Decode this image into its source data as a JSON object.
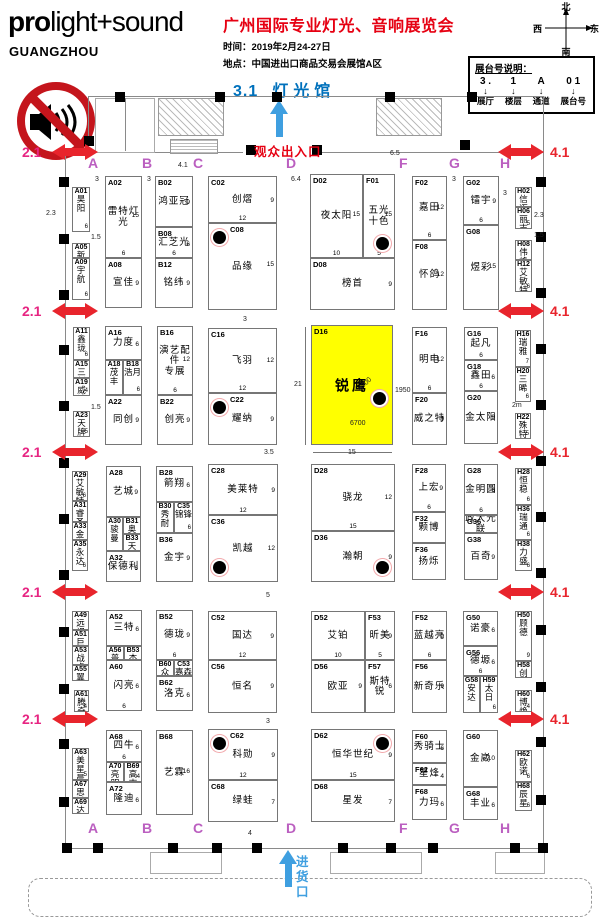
{
  "logo": {
    "pro": "pro",
    "rest": "light+sound",
    "city": "GUANGZHOU"
  },
  "header": {
    "title": "广州国际专业灯光、音响展览会",
    "date_line": "时间：2019年2月24-27日",
    "venue_line": "地点：中国进出口商品交易会展馆A区",
    "hall_no": "3.1",
    "hall_name": "灯光馆"
  },
  "compass": {
    "n": "北",
    "s": "南",
    "e": "东",
    "w": "西"
  },
  "legend": {
    "title": "展台号说明：",
    "arrow_icon": "↓",
    "cols": [
      {
        "part": "3 .",
        "meaning": "展厅"
      },
      {
        "part": "1",
        "meaning": "楼层"
      },
      {
        "part": "A",
        "meaning": "通道"
      },
      {
        "part": "0 1",
        "meaning": "展台号"
      }
    ]
  },
  "entrances": {
    "visitor": "观众出入口",
    "goods": "进货口"
  },
  "aisle_letters": {
    "top_y": 155,
    "bottom_y": 820,
    "items": [
      {
        "t": "A",
        "x": 88
      },
      {
        "t": "B",
        "x": 142
      },
      {
        "t": "C",
        "x": 193
      },
      {
        "t": "D",
        "x": 286
      },
      {
        "t": "F",
        "x": 399
      },
      {
        "t": "G",
        "x": 449
      },
      {
        "t": "H",
        "x": 500
      }
    ]
  },
  "side_arrows": {
    "left_label": "2.1",
    "right_label": "4.1",
    "rows": [
      144,
      303,
      444,
      584,
      711
    ]
  },
  "highlight": {
    "booth": "D16",
    "color": "#ffff00"
  },
  "booths": [
    {
      "id": "A01",
      "nm": "昊阳",
      "x": 72,
      "y": 187,
      "w": 18,
      "h": 45,
      "n": "6"
    },
    {
      "id": "A05",
      "nm": "新产业",
      "x": 72,
      "y": 243,
      "w": 18,
      "h": 15
    },
    {
      "id": "A09",
      "nm": "宇航",
      "x": 72,
      "y": 258,
      "w": 18,
      "h": 42,
      "n": "6"
    },
    {
      "id": "A02",
      "nm": "雷特灯光",
      "x": 105,
      "y": 176,
      "w": 37,
      "h": 82,
      "n": "15",
      "wn": "6"
    },
    {
      "id": "A08",
      "nm": "宣佳",
      "x": 105,
      "y": 258,
      "w": 37,
      "h": 50,
      "n": "9"
    },
    {
      "id": "B02",
      "nm": "鸿亚冠",
      "x": 155,
      "y": 176,
      "w": 38,
      "h": 51,
      "n": "9"
    },
    {
      "id": "B08",
      "nm": "汇芝光",
      "x": 155,
      "y": 227,
      "w": 38,
      "h": 31,
      "n": "6",
      "wn": "6"
    },
    {
      "id": "B12",
      "nm": "铭纬",
      "x": 155,
      "y": 258,
      "w": 38,
      "h": 50,
      "n": "9"
    },
    {
      "id": "C02",
      "nm": "创熠",
      "x": 208,
      "y": 176,
      "w": 69,
      "h": 47,
      "n": "9",
      "wn": "12"
    },
    {
      "id": "C08",
      "nm": "品缘",
      "x": 208,
      "y": 223,
      "w": 69,
      "h": 87,
      "n": "15",
      "p": "tl"
    },
    {
      "id": "D02",
      "nm": "夜太阳",
      "x": 310,
      "y": 174,
      "w": 53,
      "h": 84,
      "n": "15",
      "wn": "10"
    },
    {
      "id": "F01",
      "nm": "五光\n十色",
      "x": 363,
      "y": 174,
      "w": 32,
      "h": 84,
      "n": "15",
      "wn": "5",
      "p": "br"
    },
    {
      "id": "D08",
      "nm": "榜首",
      "x": 310,
      "y": 258,
      "w": 85,
      "h": 52,
      "n": "9"
    },
    {
      "id": "F02",
      "nm": "嘉田",
      "x": 412,
      "y": 176,
      "w": 35,
      "h": 64,
      "n": "12",
      "wn": "6"
    },
    {
      "id": "F08",
      "nm": "怀鸽",
      "x": 412,
      "y": 240,
      "w": 35,
      "h": 70,
      "n": "12"
    },
    {
      "id": "G02",
      "nm": "镭宇",
      "x": 463,
      "y": 176,
      "w": 36,
      "h": 49,
      "n": "9",
      "wn": "6"
    },
    {
      "id": "G08",
      "nm": "煜彩",
      "x": 463,
      "y": 225,
      "w": 36,
      "h": 85,
      "n": "15"
    },
    {
      "id": "H02",
      "nm": "信迈",
      "x": 515,
      "y": 187,
      "w": 17,
      "h": 20
    },
    {
      "id": "H06",
      "nm": "丽志",
      "x": 515,
      "y": 207,
      "w": 17,
      "h": 22,
      "n": "5"
    },
    {
      "id": "H08",
      "nm": "伟峰",
      "x": 515,
      "y": 240,
      "w": 17,
      "h": 20
    },
    {
      "id": "H12",
      "nm": "艾敏特",
      "x": 515,
      "y": 260,
      "w": 17,
      "h": 32,
      "n": "6"
    },
    {
      "id": "A11",
      "nm": "鑫珑",
      "x": 73,
      "y": 327,
      "w": 17,
      "h": 33,
      "n": "6"
    },
    {
      "id": "A15",
      "nm": "三新",
      "x": 73,
      "y": 360,
      "w": 17,
      "h": 18
    },
    {
      "id": "A19",
      "nm": "威浦",
      "x": 73,
      "y": 378,
      "w": 17,
      "h": 18,
      "n": "4"
    },
    {
      "id": "A23",
      "nm": "天牌",
      "x": 73,
      "y": 411,
      "w": 17,
      "h": 26,
      "n": "5"
    },
    {
      "id": "A16",
      "nm": "力度",
      "x": 105,
      "y": 326,
      "w": 37,
      "h": 34,
      "n": "6"
    },
    {
      "id": "A18",
      "nm": "茂丰",
      "x": 105,
      "y": 360,
      "w": 18,
      "h": 35
    },
    {
      "id": "B18",
      "nm": "浩月",
      "x": 123,
      "y": 360,
      "w": 19,
      "h": 35,
      "n": "6"
    },
    {
      "id": "A22",
      "nm": "同创",
      "x": 105,
      "y": 395,
      "w": 37,
      "h": 50,
      "n": "9"
    },
    {
      "id": "B16",
      "nm": "演艺配件\n专展",
      "x": 157,
      "y": 326,
      "w": 36,
      "h": 69,
      "n": "12",
      "wn": "6"
    },
    {
      "id": "B22",
      "nm": "创亮",
      "x": 157,
      "y": 395,
      "w": 36,
      "h": 50,
      "n": "9"
    },
    {
      "id": "C16",
      "nm": "飞羽",
      "x": 208,
      "y": 328,
      "w": 69,
      "h": 65,
      "n": "12",
      "wn": "12"
    },
    {
      "id": "C22",
      "nm": "耀纳",
      "x": 208,
      "y": 393,
      "w": 69,
      "h": 52,
      "n": "9",
      "p": "tl"
    },
    {
      "id": "D16",
      "nm": "锐鹰",
      "x": 311,
      "y": 325,
      "w": 82,
      "h": 120,
      "hl": true,
      "p": "rm"
    },
    {
      "id": "F16",
      "nm": "明电",
      "x": 412,
      "y": 327,
      "w": 35,
      "h": 66,
      "n": "12",
      "wn": "6"
    },
    {
      "id": "F20",
      "nm": "威之特",
      "x": 412,
      "y": 393,
      "w": 35,
      "h": 52,
      "n": "9"
    },
    {
      "id": "G16",
      "nm": "起凡",
      "x": 464,
      "y": 327,
      "w": 34,
      "h": 33,
      "wn": "6"
    },
    {
      "id": "G18",
      "nm": "鑫田",
      "x": 464,
      "y": 360,
      "w": 34,
      "h": 31,
      "n": "6",
      "wn": "6"
    },
    {
      "id": "G20",
      "nm": "金太阳",
      "x": 464,
      "y": 391,
      "w": 34,
      "h": 53,
      "n": "9"
    },
    {
      "id": "H16",
      "nm": "瑞雅",
      "x": 515,
      "y": 330,
      "w": 16,
      "h": 37,
      "n": "7"
    },
    {
      "id": "H20",
      "nm": "三晞",
      "x": 515,
      "y": 367,
      "w": 16,
      "h": 35,
      "n": "6"
    },
    {
      "id": "H22",
      "nm": "殊特",
      "x": 515,
      "y": 413,
      "w": 16,
      "h": 26,
      "n": "5"
    },
    {
      "id": "A29",
      "nm": "艾敏特",
      "x": 72,
      "y": 471,
      "w": 16,
      "h": 30,
      "n": "6"
    },
    {
      "id": "A31",
      "nm": "睿圣",
      "x": 72,
      "y": 501,
      "w": 16,
      "h": 21
    },
    {
      "id": "A33",
      "nm": "金海洋",
      "x": 72,
      "y": 522,
      "w": 16,
      "h": 18
    },
    {
      "id": "A35",
      "nm": "永达",
      "x": 72,
      "y": 540,
      "w": 16,
      "h": 31,
      "n": "6"
    },
    {
      "id": "A28",
      "nm": "艺城",
      "x": 106,
      "y": 466,
      "w": 35,
      "h": 51,
      "n": "9"
    },
    {
      "id": "A30",
      "nm": "骏曼",
      "x": 106,
      "y": 517,
      "w": 17,
      "h": 34
    },
    {
      "id": "B31",
      "nm": "奥音德",
      "x": 123,
      "y": 517,
      "w": 18,
      "h": 17
    },
    {
      "id": "B33",
      "nm": "天骄",
      "x": 123,
      "y": 534,
      "w": 18,
      "h": 17
    },
    {
      "id": "A32",
      "nm": "保德利",
      "x": 106,
      "y": 551,
      "w": 35,
      "h": 31,
      "n": "6"
    },
    {
      "id": "B28",
      "nm": "箭翔",
      "x": 156,
      "y": 466,
      "w": 37,
      "h": 36,
      "n": "6"
    },
    {
      "id": "B30",
      "nm": "秀耐",
      "x": 156,
      "y": 502,
      "w": 18,
      "h": 31
    },
    {
      "id": "C35",
      "nm": "锦锋",
      "x": 174,
      "y": 502,
      "w": 19,
      "h": 31,
      "n": "6"
    },
    {
      "id": "B36",
      "nm": "金宇",
      "x": 156,
      "y": 533,
      "w": 37,
      "h": 49,
      "n": "9"
    },
    {
      "id": "C28",
      "nm": "美莱特",
      "x": 208,
      "y": 464,
      "w": 70,
      "h": 51,
      "n": "9",
      "wn": "12"
    },
    {
      "id": "C36",
      "nm": "凯越",
      "x": 208,
      "y": 515,
      "w": 70,
      "h": 67,
      "n": "12",
      "p": "bl"
    },
    {
      "id": "D28",
      "nm": "骁龙",
      "x": 311,
      "y": 464,
      "w": 84,
      "h": 67,
      "n": "12",
      "wn": "15"
    },
    {
      "id": "D36",
      "nm": "瀚朝",
      "x": 311,
      "y": 531,
      "w": 84,
      "h": 51,
      "n": "9",
      "p": "br"
    },
    {
      "id": "F28",
      "nm": "上宏",
      "x": 412,
      "y": 464,
      "w": 34,
      "h": 48,
      "n": "9",
      "wn": "6"
    },
    {
      "id": "F32",
      "nm": "颗博",
      "x": 412,
      "y": 512,
      "w": 34,
      "h": 31
    },
    {
      "id": "F36",
      "nm": "扬烁",
      "x": 412,
      "y": 543,
      "w": 34,
      "h": 37
    },
    {
      "id": "G28",
      "nm": "金明圆",
      "x": 464,
      "y": 464,
      "w": 34,
      "h": 51,
      "n": "6",
      "wn": "6"
    },
    {
      "id": "G36",
      "nm": "政大光联",
      "x": 464,
      "y": 515,
      "w": 34,
      "h": 18
    },
    {
      "id": "G38",
      "nm": "百奇",
      "x": 464,
      "y": 533,
      "w": 34,
      "h": 47,
      "n": "9"
    },
    {
      "id": "H28",
      "nm": "恒稳",
      "x": 515,
      "y": 468,
      "w": 17,
      "h": 37,
      "n": "6"
    },
    {
      "id": "H36",
      "nm": "瑞通",
      "x": 515,
      "y": 505,
      "w": 17,
      "h": 35,
      "n": "6"
    },
    {
      "id": "H38",
      "nm": "力盛",
      "x": 515,
      "y": 540,
      "w": 17,
      "h": 31,
      "n": "6"
    },
    {
      "id": "A49",
      "nm": "远视",
      "x": 72,
      "y": 611,
      "w": 17,
      "h": 19
    },
    {
      "id": "A51",
      "nm": "巨盈",
      "x": 72,
      "y": 630,
      "w": 17,
      "h": 16
    },
    {
      "id": "A53",
      "nm": "战虎",
      "x": 72,
      "y": 646,
      "w": 17,
      "h": 19
    },
    {
      "id": "A55",
      "nm": "翼德",
      "x": 72,
      "y": 665,
      "w": 17,
      "h": 16
    },
    {
      "id": "A61",
      "nm": "腾奇",
      "x": 74,
      "y": 690,
      "w": 15,
      "h": 22,
      "n": "4"
    },
    {
      "id": "A52",
      "nm": "三特",
      "x": 106,
      "y": 610,
      "w": 36,
      "h": 36,
      "n": "6"
    },
    {
      "id": "A56",
      "nm": "普慧",
      "x": 106,
      "y": 646,
      "w": 18,
      "h": 14
    },
    {
      "id": "B53",
      "nm": "杰江",
      "x": 124,
      "y": 646,
      "w": 18,
      "h": 14
    },
    {
      "id": "A60",
      "nm": "闪亮",
      "x": 106,
      "y": 660,
      "w": 36,
      "h": 51,
      "n": "6",
      "wn": "6"
    },
    {
      "id": "B52",
      "nm": "德珑",
      "x": 156,
      "y": 610,
      "w": 37,
      "h": 50,
      "n": "9",
      "wn": "6"
    },
    {
      "id": "B60",
      "nm": "众纳",
      "x": 156,
      "y": 660,
      "w": 18,
      "h": 16
    },
    {
      "id": "C53",
      "nm": "嘉森",
      "x": 174,
      "y": 660,
      "w": 19,
      "h": 16
    },
    {
      "id": "B62",
      "nm": "洛克",
      "x": 156,
      "y": 676,
      "w": 37,
      "h": 35,
      "n": "6"
    },
    {
      "id": "C52",
      "nm": "国达",
      "x": 208,
      "y": 611,
      "w": 69,
      "h": 49,
      "n": "9",
      "wn": "12"
    },
    {
      "id": "C56",
      "nm": "恒名",
      "x": 208,
      "y": 660,
      "w": 69,
      "h": 53,
      "n": "9"
    },
    {
      "id": "D52",
      "nm": "艾铂",
      "x": 311,
      "y": 611,
      "w": 54,
      "h": 49,
      "wn": "10"
    },
    {
      "id": "F53",
      "nm": "昕美",
      "x": 365,
      "y": 611,
      "w": 30,
      "h": 49,
      "n": "9",
      "wn": "5"
    },
    {
      "id": "D56",
      "nm": "欧亚",
      "x": 311,
      "y": 660,
      "w": 54,
      "h": 53,
      "n": "9"
    },
    {
      "id": "F57",
      "nm": "斯特锐",
      "x": 365,
      "y": 660,
      "w": 30,
      "h": 53,
      "n": "6"
    },
    {
      "id": "F52",
      "nm": "蓝越亮",
      "x": 412,
      "y": 611,
      "w": 35,
      "h": 49,
      "n": "9",
      "wn": "6"
    },
    {
      "id": "F56",
      "nm": "新奇乐",
      "x": 412,
      "y": 660,
      "w": 35,
      "h": 53,
      "n": "9"
    },
    {
      "id": "G50",
      "nm": "诺豪",
      "x": 463,
      "y": 611,
      "w": 35,
      "h": 35,
      "n": "6"
    },
    {
      "id": "G56",
      "nm": "德塬",
      "x": 463,
      "y": 646,
      "w": 35,
      "h": 30,
      "n": "6",
      "wn": "6"
    },
    {
      "id": "G58",
      "nm": "安达",
      "x": 463,
      "y": 676,
      "w": 17,
      "h": 37
    },
    {
      "id": "H59",
      "nm": "太日",
      "x": 480,
      "y": 676,
      "w": 18,
      "h": 37,
      "n": "6"
    },
    {
      "id": "H50",
      "nm": "顾德",
      "x": 515,
      "y": 611,
      "w": 17,
      "h": 50,
      "n": "9"
    },
    {
      "id": "H58",
      "nm": "创宇",
      "x": 515,
      "y": 661,
      "w": 17,
      "h": 17
    },
    {
      "id": "H60",
      "nm": "博焕",
      "x": 515,
      "y": 690,
      "w": 17,
      "h": 22,
      "n": "4"
    },
    {
      "id": "A63",
      "nm": "美星晨",
      "x": 72,
      "y": 748,
      "w": 17,
      "h": 32,
      "n": "5"
    },
    {
      "id": "A67",
      "nm": "思城",
      "x": 72,
      "y": 780,
      "w": 17,
      "h": 18
    },
    {
      "id": "A69",
      "nm": "达欣",
      "x": 72,
      "y": 798,
      "w": 17,
      "h": 16
    },
    {
      "id": "A68",
      "nm": "四牛",
      "x": 106,
      "y": 730,
      "w": 36,
      "h": 32,
      "n": "6",
      "wn": "6"
    },
    {
      "id": "A70",
      "nm": "亮明",
      "x": 106,
      "y": 762,
      "w": 18,
      "h": 20
    },
    {
      "id": "B69",
      "nm": "高志忠",
      "x": 124,
      "y": 762,
      "w": 18,
      "h": 20,
      "n": "4"
    },
    {
      "id": "A72",
      "nm": "隆迪",
      "x": 106,
      "y": 782,
      "w": 36,
      "h": 33,
      "n": "6"
    },
    {
      "id": "B68",
      "nm": "艺霖",
      "x": 156,
      "y": 730,
      "w": 37,
      "h": 85,
      "n": "16"
    },
    {
      "id": "C62",
      "nm": "科勋",
      "x": 208,
      "y": 729,
      "w": 70,
      "h": 51,
      "n": "9",
      "wn": "12",
      "p": "tl"
    },
    {
      "id": "C68",
      "nm": "绿蛙",
      "x": 208,
      "y": 780,
      "w": 70,
      "h": 42,
      "n": "7"
    },
    {
      "id": "D62",
      "nm": "恒华世纪",
      "x": 311,
      "y": 729,
      "w": 84,
      "h": 51,
      "n": "9",
      "wn": "15",
      "p": "tr"
    },
    {
      "id": "D68",
      "nm": "星发",
      "x": 311,
      "y": 780,
      "w": 84,
      "h": 42,
      "n": "7"
    },
    {
      "id": "F60",
      "nm": "秀骑士",
      "x": 412,
      "y": 730,
      "w": 35,
      "h": 33,
      "n": "6"
    },
    {
      "id": "F62",
      "nm": "星烽",
      "x": 412,
      "y": 763,
      "w": 35,
      "h": 22,
      "n": "4"
    },
    {
      "id": "F68",
      "nm": "力玛",
      "x": 412,
      "y": 785,
      "w": 35,
      "h": 35,
      "n": "6"
    },
    {
      "id": "G60",
      "nm": "金崴",
      "x": 463,
      "y": 730,
      "w": 35,
      "h": 57,
      "n": "10"
    },
    {
      "id": "G68",
      "nm": "丰业",
      "x": 463,
      "y": 787,
      "w": 35,
      "h": 33,
      "n": "6"
    },
    {
      "id": "H62",
      "nm": "欧诺",
      "x": 515,
      "y": 750,
      "w": 17,
      "h": 32,
      "n": "6"
    },
    {
      "id": "H68",
      "nm": "辰星",
      "x": 515,
      "y": 782,
      "w": 17,
      "h": 29,
      "n": "6"
    }
  ],
  "dims": [
    {
      "t": "3",
      "x": 95,
      "y": 176
    },
    {
      "t": "3",
      "x": 147,
      "y": 176
    },
    {
      "t": "4.1",
      "x": 178,
      "y": 162
    },
    {
      "t": "6.4",
      "x": 291,
      "y": 176
    },
    {
      "t": "6.5",
      "x": 390,
      "y": 150
    },
    {
      "t": "3",
      "x": 452,
      "y": 176
    },
    {
      "t": "3",
      "x": 503,
      "y": 190
    },
    {
      "t": "2.3",
      "x": 46,
      "y": 210
    },
    {
      "t": "1.5",
      "x": 91,
      "y": 234
    },
    {
      "t": "2.3",
      "x": 534,
      "y": 212
    },
    {
      "t": "1.5",
      "x": 534,
      "y": 232
    },
    {
      "t": "3",
      "x": 243,
      "y": 316
    },
    {
      "t": "1.5",
      "x": 91,
      "y": 404
    },
    {
      "t": "3.5",
      "x": 264,
      "y": 449
    },
    {
      "t": "2m",
      "x": 512,
      "y": 402
    },
    {
      "t": "21",
      "x": 294,
      "y": 381
    },
    {
      "t": "15",
      "x": 348,
      "y": 449
    },
    {
      "t": "6700",
      "x": 350,
      "y": 420
    },
    {
      "t": "φ700",
      "x": 357,
      "y": 381,
      "rot": -45
    },
    {
      "t": "1950",
      "x": 395,
      "y": 387
    },
    {
      "t": "5",
      "x": 266,
      "y": 592
    },
    {
      "t": "3",
      "x": 266,
      "y": 718
    },
    {
      "t": "4",
      "x": 248,
      "y": 830
    }
  ]
}
